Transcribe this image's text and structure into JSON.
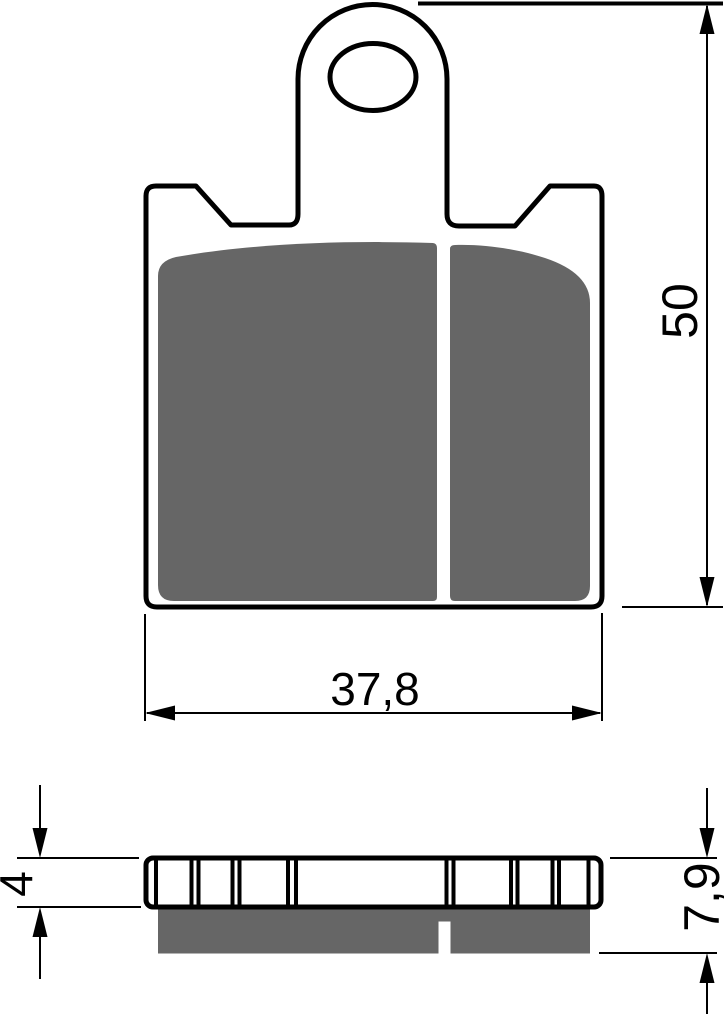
{
  "drawing": {
    "kind": "technical-drawing",
    "views": {
      "front": "brake pad front view with mounting tab, hole and split friction material",
      "side": "brake pad side profile with segmented backing plate and friction layer"
    }
  },
  "labels": {
    "height": "50",
    "width": "37,8",
    "plate_thickness": "4",
    "total_thickness": "7,9"
  },
  "colors": {
    "line": "#000000",
    "friction": "#666666",
    "background": "#ffffff",
    "dim_line": "#000000"
  },
  "side_view": {
    "divider_x": [
      156,
      191.5,
      198.5,
      232.5,
      239.5,
      288,
      296,
      446.5,
      453.5,
      511,
      517.5,
      552.5,
      559,
      588.5
    ]
  }
}
